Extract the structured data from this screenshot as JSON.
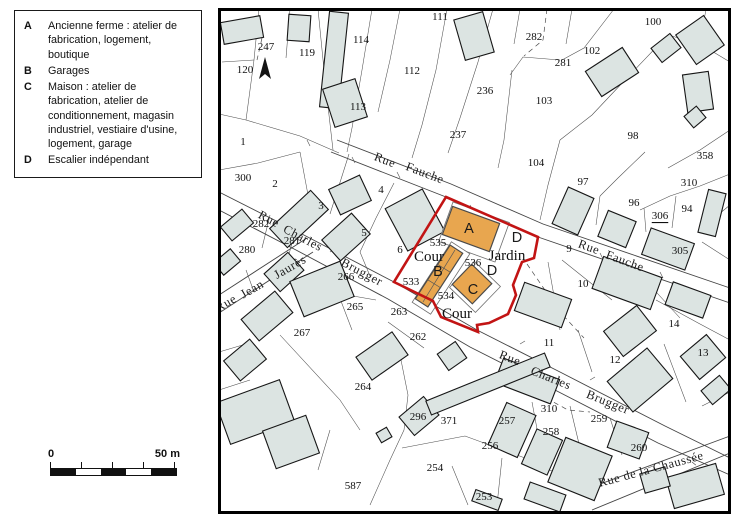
{
  "legend": {
    "items": [
      {
        "key": "A",
        "text": "Ancienne ferme : atelier de fabrication, logement, boutique"
      },
      {
        "key": "B",
        "text": "Garages"
      },
      {
        "key": "C",
        "text": "Maison : atelier de fabrication, atelier de conditionnement, magasin industriel, vestiaire d'usine, logement, garage"
      },
      {
        "key": "D",
        "text": "Escalier indépendant"
      }
    ]
  },
  "scalebar": {
    "zero": "0",
    "max": "50 m"
  },
  "map": {
    "colors": {
      "plot_boundary": "#c21414",
      "highlight_building": "#e8a64f",
      "building_fill": "#dce4e2"
    },
    "parcels": [
      {
        "t": "247",
        "x": 266,
        "y": 47
      },
      {
        "t": "119",
        "x": 307,
        "y": 53
      },
      {
        "t": "120",
        "x": 245,
        "y": 70
      },
      {
        "t": "114",
        "x": 361,
        "y": 40
      },
      {
        "t": "111",
        "x": 440,
        "y": 17
      },
      {
        "t": "112",
        "x": 412,
        "y": 71
      },
      {
        "t": "113",
        "x": 358,
        "y": 107
      },
      {
        "t": "1",
        "x": 243,
        "y": 142
      },
      {
        "t": "237",
        "x": 458,
        "y": 135
      },
      {
        "t": "282",
        "x": 534,
        "y": 37
      },
      {
        "t": "281",
        "x": 563,
        "y": 63
      },
      {
        "t": "102",
        "x": 592,
        "y": 51
      },
      {
        "t": "100",
        "x": 653,
        "y": 22
      },
      {
        "t": "236",
        "x": 485,
        "y": 91
      },
      {
        "t": "103",
        "x": 544,
        "y": 101
      },
      {
        "t": "98",
        "x": 633,
        "y": 136
      },
      {
        "t": "358",
        "x": 705,
        "y": 156
      },
      {
        "t": "104",
        "x": 536,
        "y": 163
      },
      {
        "t": "310",
        "x": 689,
        "y": 183
      },
      {
        "t": "97",
        "x": 583,
        "y": 182
      },
      {
        "t": "96",
        "x": 634,
        "y": 203
      },
      {
        "t": "94",
        "x": 687,
        "y": 209
      },
      {
        "t": "306",
        "x": 660,
        "y": 216,
        "u": true
      },
      {
        "t": "305",
        "x": 680,
        "y": 251
      },
      {
        "t": "300",
        "x": 243,
        "y": 178
      },
      {
        "t": "2",
        "x": 275,
        "y": 184
      },
      {
        "t": "3",
        "x": 321,
        "y": 206
      },
      {
        "t": "4",
        "x": 381,
        "y": 190
      },
      {
        "t": "5",
        "x": 364,
        "y": 233
      },
      {
        "t": "6",
        "x": 400,
        "y": 250
      },
      {
        "t": "282",
        "x": 261,
        "y": 224
      },
      {
        "t": "281",
        "x": 292,
        "y": 241
      },
      {
        "t": "280",
        "x": 247,
        "y": 250
      },
      {
        "t": "266",
        "x": 346,
        "y": 277
      },
      {
        "t": "265",
        "x": 355,
        "y": 307
      },
      {
        "t": "267",
        "x": 302,
        "y": 333
      },
      {
        "t": "533",
        "x": 411,
        "y": 282
      },
      {
        "t": "535",
        "x": 438,
        "y": 243
      },
      {
        "t": "536",
        "x": 473,
        "y": 263
      },
      {
        "t": "534",
        "x": 446,
        "y": 296
      },
      {
        "t": "263",
        "x": 399,
        "y": 312
      },
      {
        "t": "262",
        "x": 418,
        "y": 337
      },
      {
        "t": "9",
        "x": 569,
        "y": 249
      },
      {
        "t": "10",
        "x": 583,
        "y": 284
      },
      {
        "t": "11",
        "x": 549,
        "y": 343
      },
      {
        "t": "12",
        "x": 615,
        "y": 360
      },
      {
        "t": "13",
        "x": 703,
        "y": 353
      },
      {
        "t": "14",
        "x": 674,
        "y": 324
      },
      {
        "t": "264",
        "x": 363,
        "y": 387
      },
      {
        "t": "296",
        "x": 418,
        "y": 417
      },
      {
        "t": "371",
        "x": 449,
        "y": 421
      },
      {
        "t": "587",
        "x": 353,
        "y": 486
      },
      {
        "t": "254",
        "x": 435,
        "y": 468
      },
      {
        "t": "256",
        "x": 490,
        "y": 446
      },
      {
        "t": "253",
        "x": 484,
        "y": 497
      },
      {
        "t": "257",
        "x": 507,
        "y": 421
      },
      {
        "t": "310",
        "x": 549,
        "y": 409
      },
      {
        "t": "258",
        "x": 551,
        "y": 432
      },
      {
        "t": "259",
        "x": 599,
        "y": 419
      },
      {
        "t": "260",
        "x": 639,
        "y": 448
      }
    ],
    "streets": [
      {
        "t": "Rue",
        "x": 385,
        "y": 160,
        "r": 21
      },
      {
        "t": "Fauche",
        "x": 425,
        "y": 173,
        "r": 21
      },
      {
        "t": "Rue",
        "x": 589,
        "y": 247,
        "r": 20
      },
      {
        "t": "Fauche",
        "x": 625,
        "y": 261,
        "r": 20
      },
      {
        "t": "Rue",
        "x": 269,
        "y": 219,
        "r": 28
      },
      {
        "t": "Charles",
        "x": 303,
        "y": 238,
        "r": 28
      },
      {
        "t": "Brugger",
        "x": 362,
        "y": 272,
        "r": 28
      },
      {
        "t": "Rue",
        "x": 510,
        "y": 358,
        "r": 21
      },
      {
        "t": "Charles",
        "x": 551,
        "y": 378,
        "r": 22
      },
      {
        "t": "Brugger",
        "x": 608,
        "y": 402,
        "r": 22
      },
      {
        "t": "Rue",
        "x": 226,
        "y": 303,
        "r": -30
      },
      {
        "t": "Jean",
        "x": 252,
        "y": 289,
        "r": -30
      },
      {
        "t": "Jaurès",
        "x": 290,
        "y": 267,
        "r": -30
      },
      {
        "t": "Rue de la Chaussée",
        "x": 651,
        "y": 469,
        "r": -15
      }
    ],
    "sites": [
      {
        "t": "Cour",
        "x": 429,
        "y": 257
      },
      {
        "t": "Jardin",
        "x": 507,
        "y": 256
      },
      {
        "t": "Cour",
        "x": 457,
        "y": 314
      }
    ],
    "letters": [
      {
        "t": "A",
        "x": 469,
        "y": 229
      },
      {
        "t": "B",
        "x": 438,
        "y": 272
      },
      {
        "t": "C",
        "x": 473,
        "y": 290
      },
      {
        "t": "D",
        "x": 517,
        "y": 238
      },
      {
        "t": "D",
        "x": 492,
        "y": 271
      }
    ]
  }
}
